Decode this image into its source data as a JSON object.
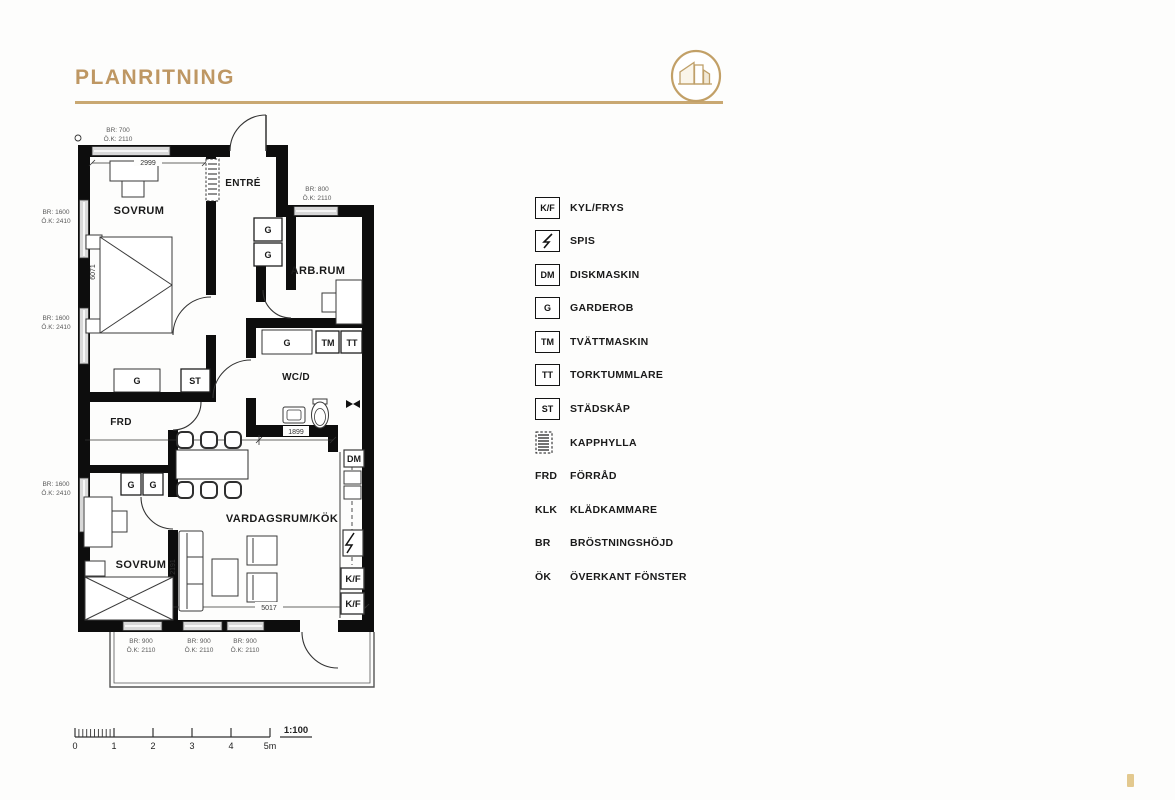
{
  "header": {
    "title": "PLANRITNING",
    "accent_color": "#C29E6A"
  },
  "plan": {
    "rooms": {
      "bedroom1": "SOVRUM",
      "entry": "ENTRÉ",
      "workroom": "ARB.RUM",
      "wc": "WC/D",
      "storage": "FRD",
      "living_kitchen": "VARDAGSRUM/KÖK",
      "bedroom2": "SOVRUM"
    },
    "fixtures": {
      "g": "G",
      "st": "ST",
      "tm": "TM",
      "tt": "TT",
      "dm": "DM",
      "kf": "K/F"
    },
    "dimensions": {
      "bedroom1_width": "2999",
      "bedroom1_length": "6071",
      "wc_width": "1899",
      "sofa_wall": "2191",
      "living_width": "5017"
    },
    "windows": {
      "top": {
        "br": "BR: 700",
        "ok": "Ö.K: 2110"
      },
      "workroom": {
        "br": "BR: 800",
        "ok": "Ö.K: 2110"
      },
      "left": {
        "br": "BR: 1600",
        "ok": "Ö.K: 2410"
      },
      "bottom": {
        "br": "BR: 900",
        "ok": "Ö.K: 2110"
      }
    }
  },
  "legend": {
    "items": [
      {
        "abbr": "K/F",
        "label": "KYL/FRYS",
        "type": "box"
      },
      {
        "abbr": "",
        "label": "SPIS",
        "type": "box-lightning"
      },
      {
        "abbr": "DM",
        "label": "DISKMASKIN",
        "type": "box"
      },
      {
        "abbr": "G",
        "label": "GARDEROB",
        "type": "box"
      },
      {
        "abbr": "TM",
        "label": "TVÄTTMASKIN",
        "type": "box"
      },
      {
        "abbr": "TT",
        "label": "TORKTUMMLARE",
        "type": "box"
      },
      {
        "abbr": "ST",
        "label": "STÄDSKÅP",
        "type": "box"
      },
      {
        "abbr": "",
        "label": "KAPPHYLLA",
        "type": "coat-rack"
      },
      {
        "abbr": "FRD",
        "label": "FÖRRÅD",
        "type": "text"
      },
      {
        "abbr": "KLK",
        "label": "KLÄDKAMMARE",
        "type": "text"
      },
      {
        "abbr": "BR",
        "label": "BRÖSTNINGSHÖJD",
        "type": "text"
      },
      {
        "abbr": "ÖK",
        "label": "ÖVERKANT FÖNSTER",
        "type": "text"
      }
    ]
  },
  "scale_bar": {
    "labels": [
      "0",
      "1",
      "2",
      "3",
      "4",
      "5m"
    ],
    "ratio": "1:100"
  }
}
